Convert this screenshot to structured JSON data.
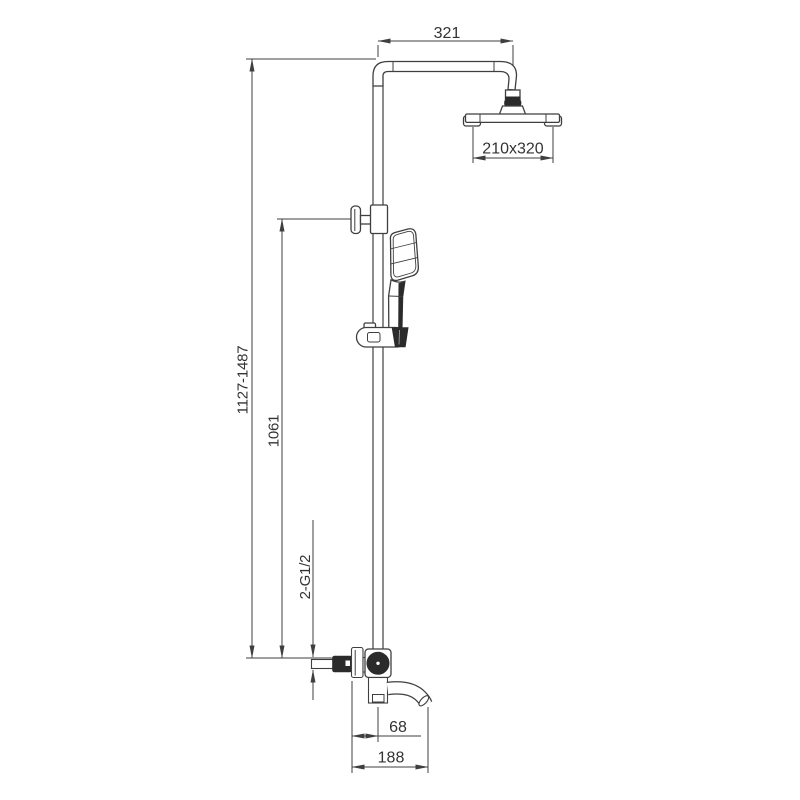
{
  "drawing": {
    "type": "technical-line-drawing",
    "subject": "shower-column-with-overhead-shower-hand-shower-and-spout"
  },
  "colors": {
    "line": "#3f3f3f",
    "dark": "#2b2b2b",
    "text": "#333333",
    "background": "#ffffff"
  },
  "dimensions": {
    "arm_width": "321",
    "head_size": "210x320",
    "overall_height": "1127-1487",
    "riser_height": "1061",
    "inlet_thread": "2-G1/2",
    "spout_center_offset": "68",
    "spout_reach": "188"
  }
}
